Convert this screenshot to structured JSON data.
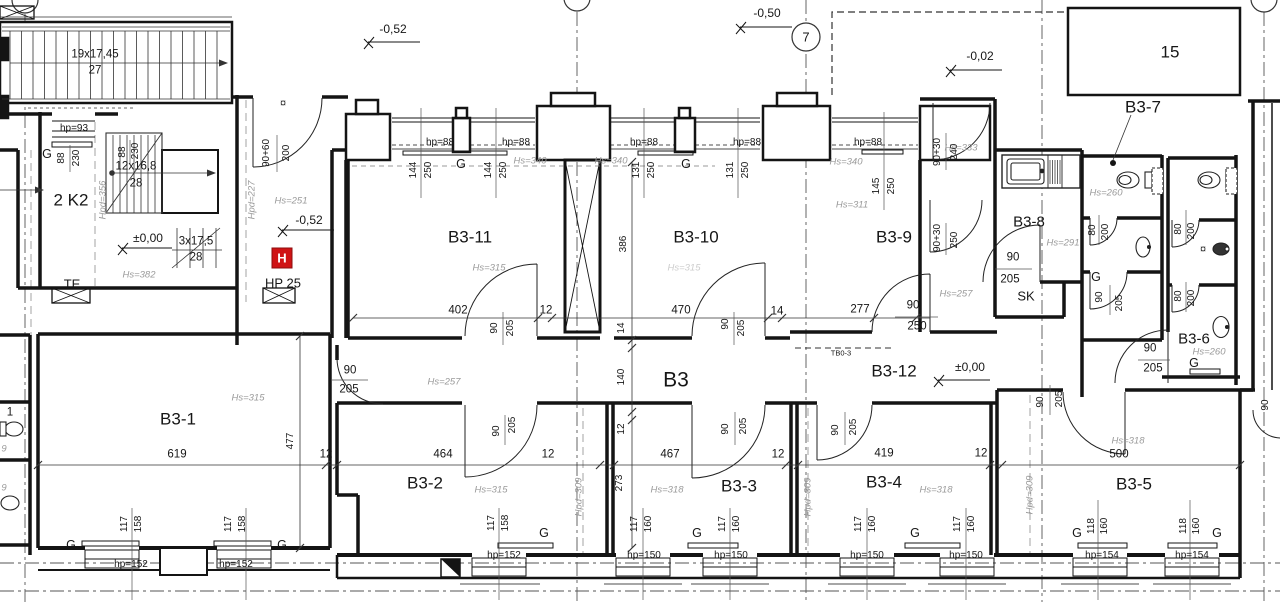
{
  "drawing": {
    "type": "architectural-floor-plan",
    "unit_block": "B3",
    "accent_red": "#cf1315",
    "line_color": "#141414",
    "annotation_gray": "#9a9a9a"
  },
  "grid": {
    "axis_label": "7"
  },
  "labels": [
    {
      "t": "19x17,45",
      "x": 95,
      "y": 55,
      "c": "dim12"
    },
    {
      "t": "27",
      "x": 95,
      "y": 71,
      "c": "dim12"
    },
    {
      "t": "hp=93",
      "x": 74,
      "y": 129,
      "c": "hp"
    },
    {
      "t": "G",
      "x": 47,
      "y": 154,
      "c": "g"
    },
    {
      "t": "88",
      "x": 62,
      "y": 158,
      "c": "dim",
      "r": 1
    },
    {
      "t": "230",
      "x": 77,
      "y": 158,
      "c": "dim",
      "r": 1
    },
    {
      "t": "88",
      "x": 123,
      "y": 152,
      "c": "dim",
      "r": 1
    },
    {
      "t": "230",
      "x": 136,
      "y": 151,
      "c": "dim",
      "r": 1
    },
    {
      "t": "12x16,8",
      "x": 136,
      "y": 167,
      "c": "dim12"
    },
    {
      "t": "28",
      "x": 136,
      "y": 184,
      "c": "dim12"
    },
    {
      "t": "2 K2",
      "x": 71,
      "y": 200,
      "c": "room-lg2"
    },
    {
      "t": "Hpd=356",
      "x": 103,
      "y": 200,
      "c": "hpd",
      "r": 1
    },
    {
      "t": "±0,00",
      "x": 148,
      "y": 238,
      "c": "lvl"
    },
    {
      "t": "3x17,5",
      "x": 196,
      "y": 242,
      "c": "dim12"
    },
    {
      "t": "28",
      "x": 196,
      "y": 258,
      "c": "dim12"
    },
    {
      "t": "Hs=382",
      "x": 139,
      "y": 275,
      "c": "hs"
    },
    {
      "t": "TE",
      "x": 72,
      "y": 284,
      "c": "room-sm"
    },
    {
      "t": "Hpd=227",
      "x": 252,
      "y": 200,
      "c": "hpd",
      "r": 1
    },
    {
      "t": "90+60",
      "x": 267,
      "y": 153,
      "c": "dim",
      "r": 1
    },
    {
      "t": "200",
      "x": 287,
      "y": 153,
      "c": "dim",
      "r": 1
    },
    {
      "t": "Hs=251",
      "x": 291,
      "y": 201,
      "c": "hs"
    },
    {
      "t": "-0,52",
      "x": 309,
      "y": 220,
      "c": "lvl"
    },
    {
      "t": "H",
      "x": 282,
      "y": 258,
      "c": "hicon",
      "n": "hydrant-icon"
    },
    {
      "t": "HP 25",
      "x": 283,
      "y": 283,
      "c": "room-sm"
    },
    {
      "t": "¤",
      "x": 283,
      "y": 104,
      "c": "sym"
    },
    {
      "t": "-0,52",
      "x": 393,
      "y": 29,
      "c": "lvl"
    },
    {
      "t": "-0,50",
      "x": 767,
      "y": 13,
      "c": "lvl"
    },
    {
      "t": "-0,02",
      "x": 980,
      "y": 56,
      "c": "lvl"
    },
    {
      "t": "15",
      "x": 1170,
      "y": 52,
      "c": "room-lg2"
    },
    {
      "t": "B3-7",
      "x": 1143,
      "y": 107,
      "c": "room-lg2"
    },
    {
      "t": "hp=88",
      "x": 440,
      "y": 143,
      "c": "hp"
    },
    {
      "t": "hp=88",
      "x": 516,
      "y": 143,
      "c": "hp"
    },
    {
      "t": "hp=88",
      "x": 644,
      "y": 143,
      "c": "hp"
    },
    {
      "t": "hp=88",
      "x": 747,
      "y": 143,
      "c": "hp"
    },
    {
      "t": "hp=88",
      "x": 868,
      "y": 143,
      "c": "hp"
    },
    {
      "t": "G",
      "x": 461,
      "y": 164,
      "c": "g"
    },
    {
      "t": "G",
      "x": 686,
      "y": 164,
      "c": "g"
    },
    {
      "t": "144",
      "x": 414,
      "y": 170,
      "c": "dim",
      "r": 1
    },
    {
      "t": "250",
      "x": 429,
      "y": 170,
      "c": "dim",
      "r": 1
    },
    {
      "t": "144",
      "x": 489,
      "y": 170,
      "c": "dim",
      "r": 1
    },
    {
      "t": "250",
      "x": 504,
      "y": 170,
      "c": "dim",
      "r": 1
    },
    {
      "t": "131",
      "x": 637,
      "y": 170,
      "c": "dim",
      "r": 1
    },
    {
      "t": "250",
      "x": 652,
      "y": 170,
      "c": "dim",
      "r": 1
    },
    {
      "t": "131",
      "x": 731,
      "y": 170,
      "c": "dim",
      "r": 1
    },
    {
      "t": "250",
      "x": 746,
      "y": 170,
      "c": "dim",
      "r": 1
    },
    {
      "t": "145",
      "x": 877,
      "y": 186,
      "c": "dim",
      "r": 1
    },
    {
      "t": "250",
      "x": 892,
      "y": 186,
      "c": "dim",
      "r": 1
    },
    {
      "t": "Hs=340",
      "x": 530,
      "y": 161,
      "c": "hs"
    },
    {
      "t": "Hs=340",
      "x": 611,
      "y": 161,
      "c": "hs"
    },
    {
      "t": "Hs=340",
      "x": 846,
      "y": 162,
      "c": "hs"
    },
    {
      "t": "Hs=333",
      "x": 961,
      "y": 148,
      "c": "hs"
    },
    {
      "t": "90+30",
      "x": 938,
      "y": 152,
      "c": "dim",
      "r": 1
    },
    {
      "t": "240",
      "x": 955,
      "y": 152,
      "c": "dim",
      "r": 1
    },
    {
      "t": "Hs=311",
      "x": 852,
      "y": 205,
      "c": "hs"
    },
    {
      "t": "B3-11",
      "x": 470,
      "y": 237,
      "c": "room-lg2"
    },
    {
      "t": "Hs=315",
      "x": 489,
      "y": 268,
      "c": "hs"
    },
    {
      "t": "B3-10",
      "x": 696,
      "y": 237,
      "c": "room-lg2"
    },
    {
      "t": "Hs=315",
      "x": 684,
      "y": 268,
      "c": "hs faint"
    },
    {
      "t": "B3-9",
      "x": 894,
      "y": 237,
      "c": "room-lg2"
    },
    {
      "t": "B3-8",
      "x": 1029,
      "y": 222,
      "c": "room"
    },
    {
      "t": "Hs=291",
      "x": 1063,
      "y": 243,
      "c": "hs"
    },
    {
      "t": "Hs=260",
      "x": 1106,
      "y": 193,
      "c": "hs"
    },
    {
      "t": "80",
      "x": 1093,
      "y": 230,
      "c": "dim",
      "r": 1
    },
    {
      "t": "200",
      "x": 1106,
      "y": 232,
      "c": "dim",
      "r": 1
    },
    {
      "t": "80",
      "x": 1179,
      "y": 229,
      "c": "dim",
      "r": 1
    },
    {
      "t": "200",
      "x": 1192,
      "y": 231,
      "c": "dim",
      "r": 1
    },
    {
      "t": "80",
      "x": 1179,
      "y": 296,
      "c": "dim",
      "r": 1
    },
    {
      "t": "200",
      "x": 1192,
      "y": 298,
      "c": "dim",
      "r": 1
    },
    {
      "t": "G",
      "x": 1096,
      "y": 277,
      "c": "g"
    },
    {
      "t": "90",
      "x": 1100,
      "y": 297,
      "c": "dim",
      "r": 1
    },
    {
      "t": "205",
      "x": 1120,
      "y": 303,
      "c": "dim",
      "r": 1
    },
    {
      "t": "90",
      "x": 1013,
      "y": 258,
      "c": "dim12"
    },
    {
      "t": "205",
      "x": 1010,
      "y": 280,
      "c": "dim12"
    },
    {
      "t": "SK",
      "x": 1026,
      "y": 296,
      "c": "room-sm"
    },
    {
      "t": "Hs=257",
      "x": 956,
      "y": 294,
      "c": "hs"
    },
    {
      "t": "90+30",
      "x": 938,
      "y": 238,
      "c": "dim",
      "r": 1
    },
    {
      "t": "250",
      "x": 955,
      "y": 240,
      "c": "dim",
      "r": 1
    },
    {
      "t": "B3-6",
      "x": 1194,
      "y": 339,
      "c": "room"
    },
    {
      "t": "Hs=260",
      "x": 1209,
      "y": 352,
      "c": "hs"
    },
    {
      "t": "90",
      "x": 1150,
      "y": 349,
      "c": "dim12"
    },
    {
      "t": "205",
      "x": 1153,
      "y": 369,
      "c": "dim12"
    },
    {
      "t": "G",
      "x": 1194,
      "y": 363,
      "c": "g"
    },
    {
      "t": "¤",
      "x": 1203,
      "y": 250,
      "c": "sym"
    },
    {
      "t": "402",
      "x": 458,
      "y": 311,
      "c": "dim12"
    },
    {
      "t": "12",
      "x": 546,
      "y": 311,
      "c": "dim12"
    },
    {
      "t": "470",
      "x": 681,
      "y": 311,
      "c": "dim12"
    },
    {
      "t": "14",
      "x": 777,
      "y": 312,
      "c": "dim12"
    },
    {
      "t": "277",
      "x": 860,
      "y": 310,
      "c": "dim12"
    },
    {
      "t": "90",
      "x": 913,
      "y": 306,
      "c": "dim12"
    },
    {
      "t": "250",
      "x": 917,
      "y": 327,
      "c": "dim12"
    },
    {
      "t": "90",
      "x": 495,
      "y": 328,
      "c": "dim",
      "r": 1
    },
    {
      "t": "205",
      "x": 511,
      "y": 328,
      "c": "dim",
      "r": 1
    },
    {
      "t": "90",
      "x": 726,
      "y": 324,
      "c": "dim",
      "r": 1
    },
    {
      "t": "205",
      "x": 742,
      "y": 328,
      "c": "dim",
      "r": 1
    },
    {
      "t": "TB0-3",
      "x": 841,
      "y": 353,
      "c": "tiny"
    },
    {
      "t": "B3",
      "x": 676,
      "y": 380,
      "c": "room-xl"
    },
    {
      "t": "B3-12",
      "x": 894,
      "y": 371,
      "c": "room-lg2"
    },
    {
      "t": "±0,00",
      "x": 970,
      "y": 367,
      "c": "lvl"
    },
    {
      "t": "Hs=257",
      "x": 444,
      "y": 382,
      "c": "hs"
    },
    {
      "t": "90",
      "x": 350,
      "y": 371,
      "c": "dim12"
    },
    {
      "t": "205",
      "x": 349,
      "y": 390,
      "c": "dim12"
    },
    {
      "t": "386",
      "x": 624,
      "y": 244,
      "c": "dim",
      "r": 1
    },
    {
      "t": "14",
      "x": 622,
      "y": 328,
      "c": "dim",
      "r": 1
    },
    {
      "t": "140",
      "x": 622,
      "y": 377,
      "c": "dim",
      "r": 1
    },
    {
      "t": "12",
      "x": 622,
      "y": 429,
      "c": "dim",
      "r": 1
    },
    {
      "t": "273",
      "x": 620,
      "y": 483,
      "c": "dim",
      "r": 1
    },
    {
      "t": "B3-1",
      "x": 178,
      "y": 419,
      "c": "room-lg2"
    },
    {
      "t": "Hs=315",
      "x": 248,
      "y": 398,
      "c": "hs"
    },
    {
      "t": "619",
      "x": 177,
      "y": 455,
      "c": "dim12"
    },
    {
      "t": "477",
      "x": 291,
      "y": 441,
      "c": "dim",
      "r": 1
    },
    {
      "t": "12",
      "x": 326,
      "y": 455,
      "c": "dim12"
    },
    {
      "t": "B3-2",
      "x": 425,
      "y": 483,
      "c": "room-lg2"
    },
    {
      "t": "Hs=315",
      "x": 491,
      "y": 490,
      "c": "hs"
    },
    {
      "t": "464",
      "x": 443,
      "y": 455,
      "c": "dim12"
    },
    {
      "t": "12",
      "x": 548,
      "y": 455,
      "c": "dim12"
    },
    {
      "t": "467",
      "x": 670,
      "y": 455,
      "c": "dim12"
    },
    {
      "t": "12",
      "x": 778,
      "y": 455,
      "c": "dim12"
    },
    {
      "t": "419",
      "x": 884,
      "y": 454,
      "c": "dim12"
    },
    {
      "t": "12",
      "x": 981,
      "y": 454,
      "c": "dim12"
    },
    {
      "t": "500",
      "x": 1119,
      "y": 455,
      "c": "dim12"
    },
    {
      "t": "B3-3",
      "x": 739,
      "y": 486,
      "c": "room-lg2"
    },
    {
      "t": "Hs=318",
      "x": 667,
      "y": 490,
      "c": "hs"
    },
    {
      "t": "B3-4",
      "x": 884,
      "y": 482,
      "c": "room-lg2"
    },
    {
      "t": "Hs=318",
      "x": 936,
      "y": 490,
      "c": "hs"
    },
    {
      "t": "B3-5",
      "x": 1134,
      "y": 484,
      "c": "room-lg2"
    },
    {
      "t": "Hs=318",
      "x": 1128,
      "y": 441,
      "c": "hs"
    },
    {
      "t": "Hpd=309",
      "x": 579,
      "y": 497,
      "c": "hpd",
      "r": 1
    },
    {
      "t": "Hpd=309",
      "x": 808,
      "y": 497,
      "c": "hpd",
      "r": 1
    },
    {
      "t": "Hpd=309",
      "x": 1030,
      "y": 495,
      "c": "hpd",
      "r": 1
    },
    {
      "t": "90",
      "x": 497,
      "y": 431,
      "c": "dim",
      "r": 1
    },
    {
      "t": "205",
      "x": 513,
      "y": 425,
      "c": "dim",
      "r": 1
    },
    {
      "t": "90",
      "x": 726,
      "y": 429,
      "c": "dim",
      "r": 1
    },
    {
      "t": "205",
      "x": 744,
      "y": 426,
      "c": "dim",
      "r": 1
    },
    {
      "t": "90",
      "x": 836,
      "y": 430,
      "c": "dim",
      "r": 1
    },
    {
      "t": "205",
      "x": 854,
      "y": 427,
      "c": "dim",
      "r": 1
    },
    {
      "t": "90",
      "x": 1041,
      "y": 402,
      "c": "dim",
      "r": 1
    },
    {
      "t": "205",
      "x": 1060,
      "y": 399,
      "c": "dim",
      "r": 1
    },
    {
      "t": "90",
      "x": 1266,
      "y": 405,
      "c": "dim",
      "r": 1
    },
    {
      "t": "117",
      "x": 125,
      "y": 524,
      "c": "dim",
      "r": 1
    },
    {
      "t": "158",
      "x": 139,
      "y": 524,
      "c": "dim",
      "r": 1
    },
    {
      "t": "117",
      "x": 229,
      "y": 524,
      "c": "dim",
      "r": 1
    },
    {
      "t": "158",
      "x": 243,
      "y": 524,
      "c": "dim",
      "r": 1
    },
    {
      "t": "G",
      "x": 71,
      "y": 545,
      "c": "g"
    },
    {
      "t": "G",
      "x": 282,
      "y": 545,
      "c": "g"
    },
    {
      "t": "hp=152",
      "x": 131,
      "y": 565,
      "c": "hp"
    },
    {
      "t": "hp=152",
      "x": 236,
      "y": 565,
      "c": "hp"
    },
    {
      "t": "117",
      "x": 492,
      "y": 523,
      "c": "dim",
      "r": 1
    },
    {
      "t": "158",
      "x": 506,
      "y": 523,
      "c": "dim",
      "r": 1
    },
    {
      "t": "G",
      "x": 544,
      "y": 533,
      "c": "g"
    },
    {
      "t": "hp=152",
      "x": 504,
      "y": 556,
      "c": "hp"
    },
    {
      "t": "117",
      "x": 635,
      "y": 524,
      "c": "dim",
      "r": 1
    },
    {
      "t": "160",
      "x": 649,
      "y": 524,
      "c": "dim",
      "r": 1
    },
    {
      "t": "117",
      "x": 723,
      "y": 524,
      "c": "dim",
      "r": 1
    },
    {
      "t": "160",
      "x": 737,
      "y": 524,
      "c": "dim",
      "r": 1
    },
    {
      "t": "G",
      "x": 697,
      "y": 533,
      "c": "g"
    },
    {
      "t": "hp=150",
      "x": 644,
      "y": 556,
      "c": "hp"
    },
    {
      "t": "hp=150",
      "x": 731,
      "y": 556,
      "c": "hp"
    },
    {
      "t": "117",
      "x": 859,
      "y": 524,
      "c": "dim",
      "r": 1
    },
    {
      "t": "160",
      "x": 873,
      "y": 524,
      "c": "dim",
      "r": 1
    },
    {
      "t": "117",
      "x": 958,
      "y": 524,
      "c": "dim",
      "r": 1
    },
    {
      "t": "160",
      "x": 972,
      "y": 524,
      "c": "dim",
      "r": 1
    },
    {
      "t": "G",
      "x": 915,
      "y": 533,
      "c": "g"
    },
    {
      "t": "hp=150",
      "x": 867,
      "y": 556,
      "c": "hp"
    },
    {
      "t": "hp=150",
      "x": 966,
      "y": 556,
      "c": "hp"
    },
    {
      "t": "118",
      "x": 1092,
      "y": 526,
      "c": "dim",
      "r": 1
    },
    {
      "t": "160",
      "x": 1105,
      "y": 526,
      "c": "dim",
      "r": 1
    },
    {
      "t": "118",
      "x": 1184,
      "y": 526,
      "c": "dim",
      "r": 1
    },
    {
      "t": "160",
      "x": 1197,
      "y": 526,
      "c": "dim",
      "r": 1
    },
    {
      "t": "G",
      "x": 1077,
      "y": 533,
      "c": "g"
    },
    {
      "t": "G",
      "x": 1217,
      "y": 533,
      "c": "g"
    },
    {
      "t": "hp=154",
      "x": 1102,
      "y": 556,
      "c": "hp"
    },
    {
      "t": "hp=154",
      "x": 1192,
      "y": 556,
      "c": "hp"
    },
    {
      "t": "1",
      "x": 10,
      "y": 413,
      "c": "dim12"
    },
    {
      "t": "9",
      "x": 4,
      "y": 449,
      "c": "hs"
    },
    {
      "t": "9",
      "x": 4,
      "y": 488,
      "c": "hs"
    },
    {
      "t": "7",
      "x": 806,
      "y": 37,
      "c": "axis",
      "n": "grid-axis-7"
    }
  ]
}
